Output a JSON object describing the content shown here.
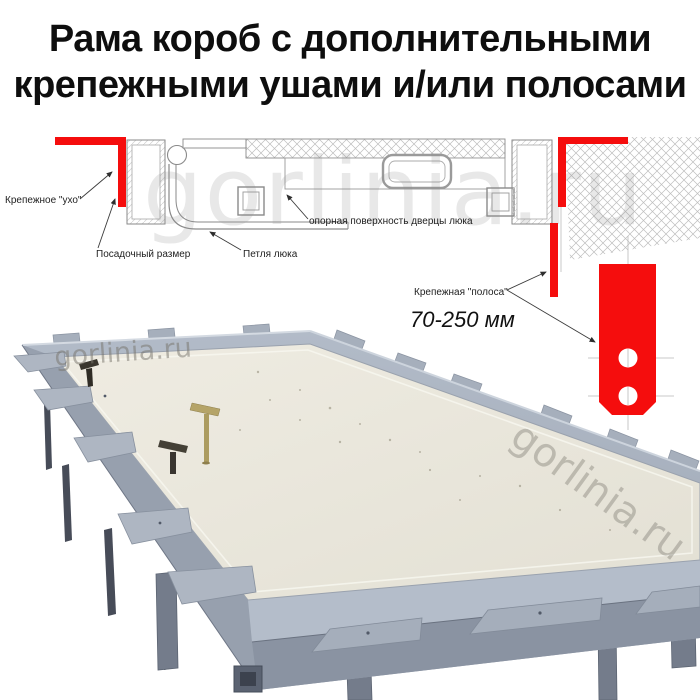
{
  "title": {
    "line1": "Рама короб с дополнительными",
    "line2": "крепежными ушами и/или полосами"
  },
  "diagram": {
    "labels": {
      "ear": "Крепежное \"ухо\"",
      "seat": "Посадочный размер",
      "hinge": "Петля люка",
      "support": "опорная поверхность дверцы люка",
      "strip": "Крепежная \"полоса\"",
      "dimension": "70-250 мм"
    },
    "colors": {
      "accent_red": "#f50d0d",
      "line_gray": "#8a8a8a",
      "centerline_gray": "#b9b9b9"
    }
  },
  "photo": {
    "colors": {
      "panel": "#ebe8dd",
      "frame_light": "#aeb7c4",
      "frame_mid": "#97a0ae",
      "frame_dark": "#8a93a2",
      "leg": "#747c8b"
    }
  },
  "watermarks": {
    "drawing": "gorlinia.ru",
    "photo_left": "gorlinia.ru",
    "photo_right": "gorlinia.ru"
  }
}
